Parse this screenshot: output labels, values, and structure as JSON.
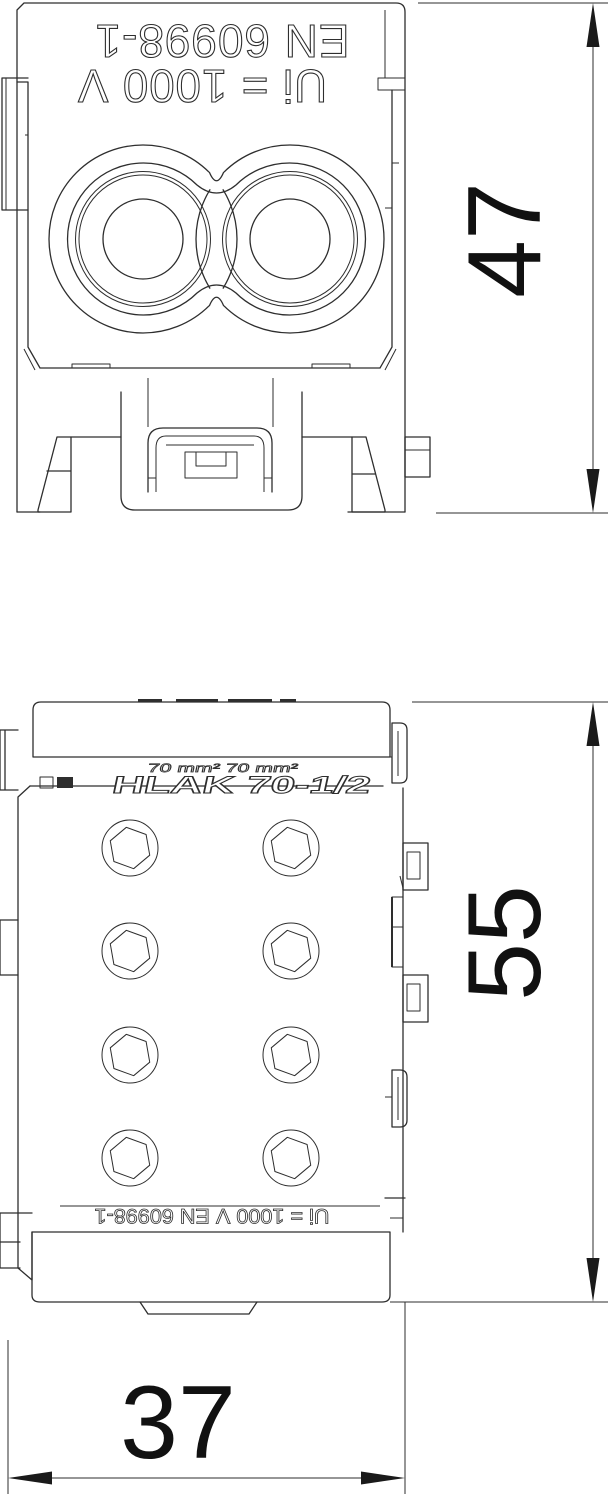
{
  "drawing": {
    "top_view": {
      "marking_line1": "EN 60998-1",
      "marking_line2": "Ui = 1000 V"
    },
    "front_view": {
      "marking_small": "70 mm²  70 mm²",
      "marking_model": "HLAK 70-1/2",
      "marking_bottom": "Ui = 1000 V  EN 60998-1"
    },
    "dimensions": {
      "top_view_height": "47",
      "front_view_height": "55",
      "front_view_width": "37"
    }
  }
}
